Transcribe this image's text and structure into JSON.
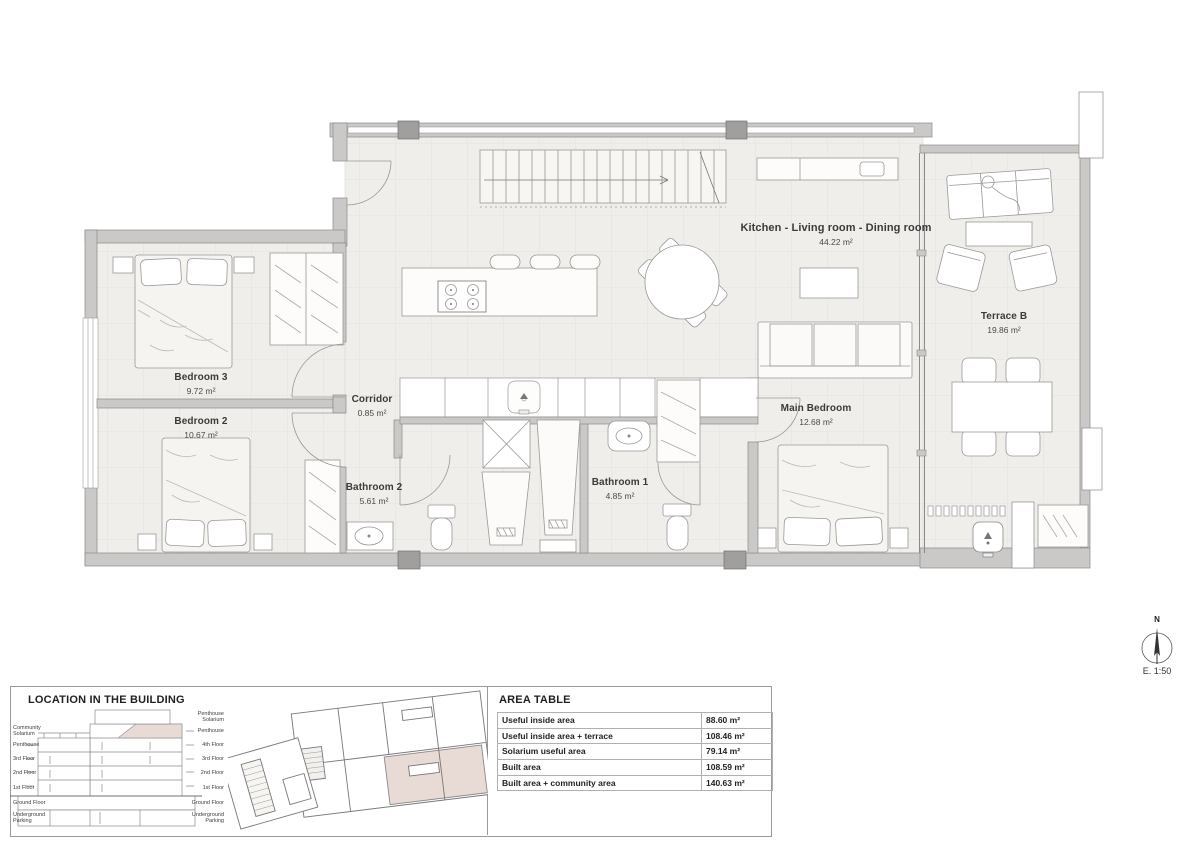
{
  "plan": {
    "rooms": {
      "kitchen_living": {
        "name": "Kitchen - Living room - Dining room",
        "area": "44.22 m²"
      },
      "terrace_b": {
        "name": "Terrace B",
        "area": "19.86 m²"
      },
      "bedroom3": {
        "name": "Bedroom 3",
        "area": "9.72 m²"
      },
      "bedroom2": {
        "name": "Bedroom 2",
        "area": "10.67 m²"
      },
      "corridor": {
        "name": "Corridor",
        "area": "0.85 m²"
      },
      "bathroom2": {
        "name": "Bathroom 2",
        "area": "5.61 m²"
      },
      "bathroom1": {
        "name": "Bathroom 1",
        "area": "4.85 m²"
      },
      "main_bedroom": {
        "name": "Main Bedroom",
        "area": "12.68 m²"
      }
    },
    "north_label": "N",
    "scale_label": "E. 1:50"
  },
  "location": {
    "title": "LOCATION IN THE BUILDING",
    "left_labels": [
      "Community Solarium",
      "Penthouse",
      "3rd Floor",
      "2nd Floor",
      "1st Floor",
      "Ground Floor",
      "Underground Parking"
    ],
    "right_labels": [
      "Penthouse Solarium",
      "Penthouse",
      "4th Floor",
      "3rd Floor",
      "2nd Floor",
      "1st Floor",
      "Ground Floor",
      "Underground Parking"
    ]
  },
  "area_table": {
    "title": "AREA TABLE",
    "rows": [
      {
        "label": "Useful inside area",
        "value": "88.60 m²"
      },
      {
        "label": "Useful inside area + terrace",
        "value": "108.46 m²"
      },
      {
        "label": "Solarium useful area",
        "value": "79.14 m²"
      },
      {
        "label": "Built area",
        "value": "108.59 m²"
      },
      {
        "label": "Built area + community area",
        "value": "140.63 m²"
      }
    ]
  },
  "colors": {
    "wall": "#cbc9c7",
    "floor": "#f0eeeb",
    "unit_highlight": "#e8dad4",
    "line": "#8a8a8a"
  }
}
